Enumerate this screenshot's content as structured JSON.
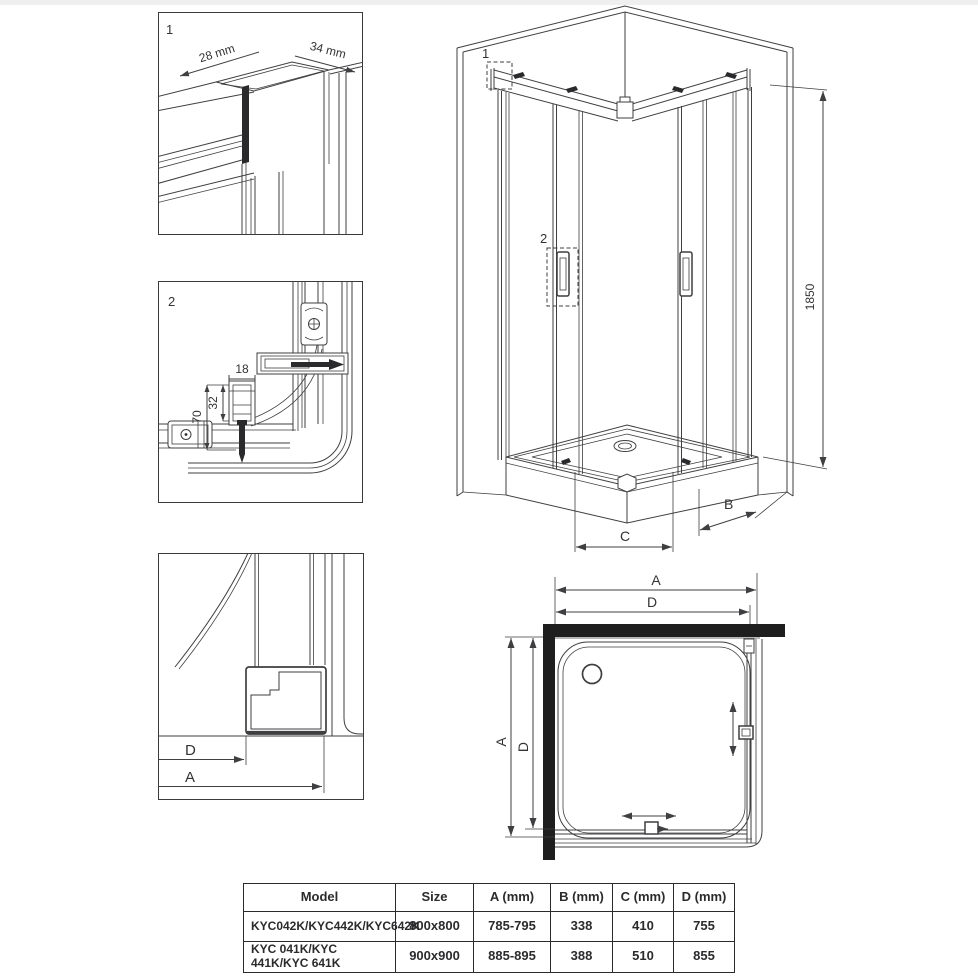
{
  "labels": {
    "detail1": {
      "num": "1",
      "width": "28 mm",
      "depth": "34 mm"
    },
    "detail2": {
      "num": "2",
      "dim18": "18",
      "dim32": "32",
      "dim70": "70"
    },
    "detail3": {
      "dimD": "D",
      "dimA": "A"
    },
    "iso": {
      "callout1": "1",
      "callout2": "2",
      "height": "1850",
      "dimB": "B",
      "dimC": "C"
    },
    "plan": {
      "aTop": "A",
      "dTop": "D",
      "aLeft": "A",
      "dLeft": "D"
    }
  },
  "table": {
    "headers": [
      "Model",
      "Size",
      "A (mm)",
      "B (mm)",
      "C (mm)",
      "D (mm)"
    ],
    "rows": [
      [
        "KYC042K/KYC442K/KYC642K",
        "800x800",
        "785-795",
        "338",
        "410",
        "755"
      ],
      [
        "KYC 041K/KYC 441K/KYC 641K",
        "900x900",
        "885-895",
        "388",
        "510",
        "855"
      ]
    ]
  },
  "colors": {
    "line": "#3f3f41",
    "wall": "#1e1e1e",
    "table_border": "#2b2b2d",
    "background": "#ffffff"
  }
}
